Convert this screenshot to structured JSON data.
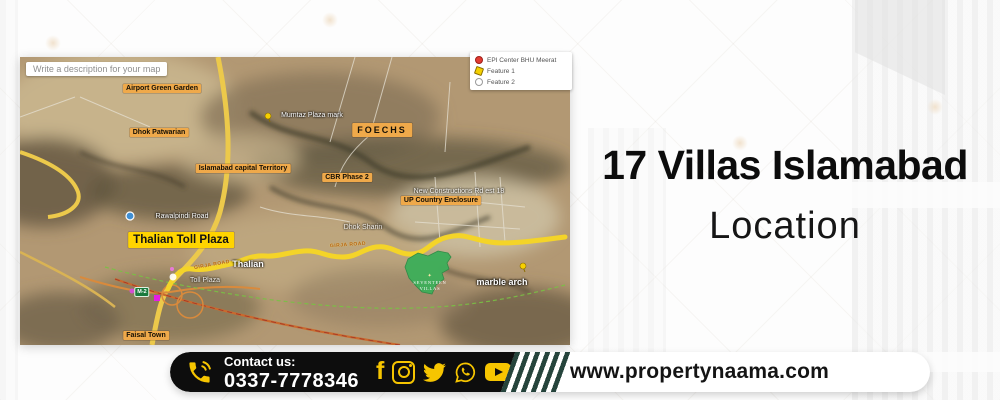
{
  "title": {
    "heading": "17 Villas Islamabad",
    "subheading": "Location"
  },
  "map": {
    "description_box": "Write a description for your map",
    "legend": [
      {
        "icon": "red-dot-icon",
        "label": "EPI Center BHU Meerat"
      },
      {
        "icon": "yellow-pin-icon",
        "label": "Feature 1"
      },
      {
        "icon": "gray-dot-icon",
        "label": "Feature 2"
      }
    ],
    "labels": {
      "airport_green_garden": "Airport Green Garden",
      "dhok_patwarian": "Dhok Patwarian",
      "foechs": "FOECHS",
      "islamabad_capital_territory": "Islamabad capital Territory",
      "cbr_phase_2": "CBR Phase 2",
      "up_country_enclosure": "UP Country Enclosure",
      "thalian_toll_plaza": "Thalian Toll Plaza",
      "faisal_town": "Faisal Town",
      "marble_arch": "marble arch",
      "thalian": "Thalian",
      "dhok_sharin": "Dhok Sharin",
      "toll_plaza": "Toll Plaza",
      "rawalpindi_road": "Rawalpindi Road",
      "constructions_rd": "New Constructions Rd est 18",
      "plaza_mark": "Mumtaz Plaza mark",
      "girja_road": "GIRJA ROAD",
      "m2_badge": "M-2",
      "site_name": "SEVENTEEN VILLAS",
      "site_logo_glyph": "✦"
    }
  },
  "footer": {
    "phone_icon": "phone-call-icon",
    "contact_label": "Contact us:",
    "phone_number": "0337-7778346",
    "social_icons": [
      "facebook-icon",
      "instagram-icon",
      "twitter-icon",
      "whatsapp-icon",
      "youtube-icon"
    ],
    "website": "www.propertynaama.com"
  },
  "colors": {
    "accent_yellow": "#F6C500",
    "footer_black": "#0D0D0D",
    "stripe_green": "#25443C",
    "map_label_orange": "#EFA94A",
    "map_label_yellow": "#FFD400",
    "route_yellow": "#F4D428",
    "site_green": "#3FAE5A",
    "title_black": "#0C0C0C"
  }
}
